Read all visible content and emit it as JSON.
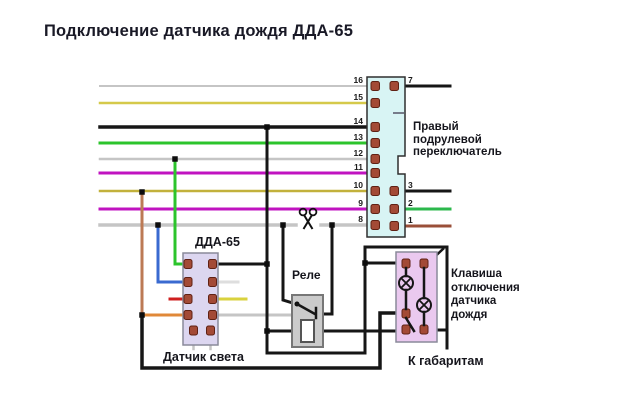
{
  "title": "Подключение датчика дождя ДДА-65",
  "connector": {
    "label": "Правый подрулевой переключатель",
    "left_pins": [
      "16",
      "15",
      "14",
      "13",
      "12",
      "11",
      "10",
      "9",
      "8"
    ],
    "right_pins": [
      "7",
      "3",
      "2",
      "1"
    ]
  },
  "dda": {
    "label": "ДДА-65",
    "sublabel": "Датчик света"
  },
  "relay": {
    "label": "Реле"
  },
  "klavisha": {
    "label": "Клавиша отключения датчика дождя"
  },
  "gabarity_label": "К габаритам",
  "colors": {
    "black_wire": "#161616",
    "gray_wire": "#c5c5c5",
    "yellow_wire": "#d5c94a",
    "olive_wire": "#c2b13c",
    "green_wire": "#2cc42c",
    "magenta_wire": "#c013c0",
    "blue_wire": "#3a6ad0",
    "red_wire": "#cf1f1f",
    "orange_wire": "#e08838",
    "brown_drop_wire": "#bc7a55",
    "brown_wire": "#9a4f38",
    "green2_wire": "#2cb84c",
    "white_stub": "#dedede",
    "yellow_stub": "#d9d23e",
    "connector_fill": "#d8f4f4",
    "dda_fill": "#dcd6f0",
    "relay_fill": "#cbcbcb",
    "klavisha_fill": "#eac9ef"
  }
}
